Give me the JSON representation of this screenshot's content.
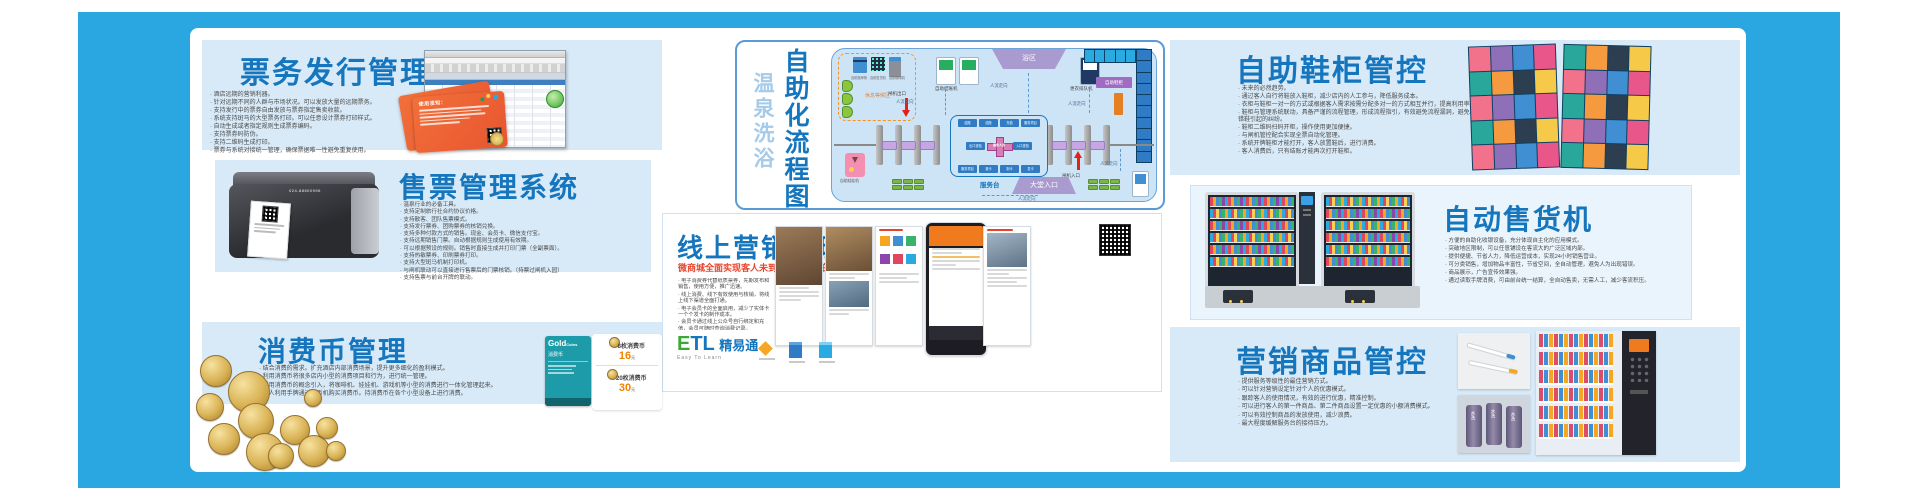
{
  "colors": {
    "frame": "#2aa7e0",
    "panel_bg": "#d8eaf8",
    "title_blue": "#1576be",
    "accent_red": "#e8432c",
    "price_orange": "#f08300",
    "dashed_orange": "#f7931e",
    "locker_photo": [
      "#f2728c",
      "#f59a3e",
      "#3f8fd2",
      "#f7c948",
      "#28a79a",
      "#8e6fb8",
      "#2c3e50",
      "#e8568a"
    ],
    "locker_diag": [
      "#21a14b",
      "#29abe2",
      "#f5a613",
      "#2f7bc4",
      "#16a085"
    ]
  },
  "ticket_issue": {
    "title": "票务发行管理系统",
    "bullets": [
      "酒店远期的营销利器。",
      "针对远期不同的人群与市场状况。可以发放大量的远期票务。",
      "支持发行中的票券自由发放与票券指定售卖收款。",
      "系统支持斑马的大型票务打印。可以任意设计票券打印样式。",
      "自动生成或者指定规则生成票券编码。",
      "支持票券码防伪。",
      "支持二维码生成打印。",
      "票券与系统对接统一管理，确保票据唯一性避免重复使用。"
    ],
    "card_title": "使用须知："
  },
  "ticket_sale": {
    "title": "售票管理系统",
    "bullets": [
      "温泉行业的必备工具。",
      "支持定制旅行社合约协议价格。",
      "支持散客、团队售票模式。",
      "支持发行票券、团购票券的核销兑换。",
      "支持多种付款方式的销售。现金、会员卡、微信支付宝。",
      "支持远期销售门票。自动根据规则生成使用有效期。",
      "可以根据预设的规则。销售时直接生成并打印门票（全副票面）。",
      "支持热敏票券、印刷票券打印。",
      "支持大型斑马机制打印机。",
      "与闸机联动可以直接进行售票后的门票核销。（持票过闸机入园）",
      "支持售票与前台开牌的联动。"
    ],
    "printer_phone": "024-88600996"
  },
  "coin": {
    "title": "消费币管理",
    "bullets": [
      "结合消费的需求。扩充酒店内部消费场景，提升更多细化的盈利模式。",
      "利用消费币将很多店内小型的消费项目和行为，进行统一管理。",
      "利用消费币的概念引入，将咖啡机、娃娃机、游戏机等小型的消费进行一体化管理起来。",
      "客人利用手牌通过发币机购买消费币。持消费币在各个小型设备上进行消费。"
    ],
    "gold_card": {
      "line1": "Gold",
      "line2": "Coins",
      "line3": "消费币"
    },
    "prices": [
      {
        "name": "8枚消费币",
        "price": "16",
        "unit": "元"
      },
      {
        "name": "20枚消费币",
        "price": "30",
        "unit": "元"
      }
    ]
  },
  "flow": {
    "title_light": "温泉洗浴",
    "title_bold": "自助化流程图",
    "labels": {
      "rest_area": "休息等候区",
      "rest_machines": [
        "自助按摩椅",
        "自助售货机",
        "自助咖啡机"
      ],
      "checkout": "自助结账机",
      "bath": "浴区",
      "queue": "更衣排队机",
      "shoe_cabinet": "自助鞋柜",
      "gate_exit": "闸机出口",
      "gate_entry": "闸机入口",
      "flow_dir": "人流走向",
      "service_desk": "服务台",
      "lobby": "大堂入口",
      "claw": "自助娃娃机",
      "ticket_kiosk": "自助售票机",
      "service_box": {
        "top": [
          "结账",
          "结账",
          "充值",
          "服务项目"
        ],
        "left": "出口查验",
        "right": "入口查验",
        "bottom": [
          "服务项目",
          "退卡",
          "制卡",
          "发卡"
        ],
        "center": "服务人员"
      }
    }
  },
  "online": {
    "title": "线上营销管理",
    "subtitle": "微商城全面实现客人未到、销售先行的理念",
    "bullets": [
      "电子消费券代替纸质票券，先期发布和销售，使用方便，推广迅速。",
      "线上消费、线下有效使用与核销，将线上线下渠道全面打通。",
      "电子会员卡的全面启用，减少了实体卡一个个发卡的制作成本。",
      "会员卡通过线上公众号自行绑定和充值，会员可随时查询消费记录。",
      "通过扫码方式进行线上的活动推广。",
      "电子优惠券自由发放，会员可通过馆内公众号自行领取和消费使用。",
      "系统针对优惠券的发放，可以分析和发布各种活动、优惠和消费使用。",
      "系统性的针对数据的分析和审核，订单和退款等数据一目了然。",
      "针对优惠券的跟踪管控，让您快速挖掘潜在的营销点。",
      "公众号活动的发布推送，让您的粉丝变成客源。"
    ],
    "logo": {
      "e": "E",
      "tl": "TL",
      "name": "精易通",
      "tagline": "Easy To Learn"
    }
  },
  "shoe": {
    "title": "自助鞋柜管控",
    "bullets": [
      "未来的必然趋势。",
      "通过客人自行将鞋放入鞋柜，减少店内的人工参与，降低服务成本。",
      "衣柜与鞋柜一对一的方式或根据客人需求按需分配多对一的方式相互并行，提高利用率。",
      "鞋柜与管理系统联动，具备严谨的流程管理，形成流程指引，有效避免流程漏洞，避免出现拿错鞋引起的纠纷。",
      "鞋柜二维码扫码开柜，操作使用更加便捷。",
      "与闸机管控配合实现全票自动化管理。",
      "系统开牌鞋柜才能打开，客人放置鞋后，进行消费。",
      "客人消费后，只有结账才能再次打开鞋柜。"
    ]
  },
  "vending": {
    "title": "自动售货机",
    "bullets": [
      "方便的自助化收银设备，充分体现自主化的应用模式。",
      "突破地区限制，可以任意铺设在客流大的广泛区域内部。",
      "提供便捷、节省人力，降低运营成本，实现24小时销售营业。",
      "可分类销售，增加物品丰富性，节省空间，全自动管理，避免人为出现错误。",
      "商品展示，广告宣传效果强。",
      "通过读取手牌消费，可由前台统一结算，全自动售卖，无需人工，减少客流积压。"
    ]
  },
  "goods": {
    "title": "营销商品管控",
    "bullets": [
      "提供服务等级性的最佳营销方式。",
      "可以针对营销设定针对个人的优惠模式。",
      "跟踪客人的使用情况，有效的进行优惠，精准控制。",
      "可以进行客人的第一件商品、第二件商品设置一定优惠的小额消费模式。",
      "可以有效控制商品的发放使用，减少浪费。",
      "最大程度缓解服务台的接待压力。"
    ],
    "roll_label": "水洗"
  }
}
